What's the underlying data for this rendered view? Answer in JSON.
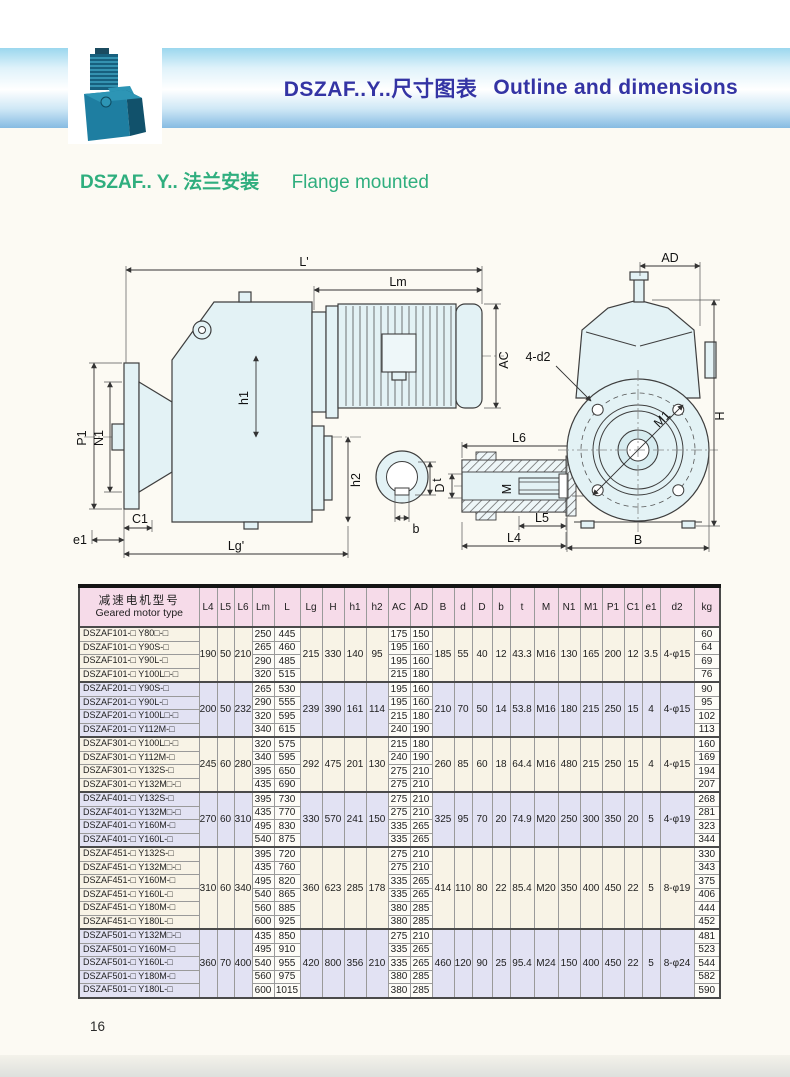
{
  "page": {
    "band_title_zh": "DSZAF..Y..尺寸图表",
    "band_title_en": "Outline and dimensions",
    "subtitle_zh": "DSZAF.. Y.. 法兰安装",
    "subtitle_en": "Flange mounted",
    "page_number": "16"
  },
  "colors": {
    "band_top": "#9bd7ee",
    "band_bottom": "#86bbe2",
    "title_text": "#3434a4",
    "subtitle_text": "#2fae7e",
    "table_header_bg": "#f6dbe9",
    "group_cream_bg": "#f8f3e6",
    "group_lavender_bg": "#e2e2f3"
  },
  "diagram": {
    "labels": {
      "l_total": "L'",
      "lm": "Lm",
      "ac": "AC",
      "h1": "h1",
      "h2": "h2",
      "p1": "P1",
      "n1": "N1",
      "e1": "e1",
      "c1": "C1",
      "lg": "Lg'",
      "b": "b",
      "t": "t",
      "l6": "L6",
      "D": "D",
      "M": "M",
      "d": "d",
      "l5": "L5",
      "l4": "L4",
      "ad": "AD",
      "d2": "4-d2",
      "H": "H",
      "m1": "M1",
      "B": "B"
    }
  },
  "table": {
    "title_cn": "减速电机型号",
    "title_en": "Geared motor type",
    "columns": [
      "L4",
      "L5",
      "L6",
      "Lm",
      "L",
      "Lg",
      "H",
      "h1",
      "h2",
      "AC",
      "AD",
      "B",
      "d",
      "D",
      "b",
      "t",
      "M",
      "N1",
      "M1",
      "P1",
      "C1",
      "e1",
      "d2",
      "kg"
    ],
    "groups": [
      {
        "shared": {
          "L4": "190",
          "L5": "50",
          "L6": "210",
          "Lg": "215",
          "H": "330",
          "h1": "140",
          "h2": "95",
          "B": "185",
          "d": "55",
          "D": "40",
          "b": "12",
          "t": "43.3",
          "M": "M16",
          "N1": "130",
          "M1": "165",
          "P1": "200",
          "C1": "12",
          "e1": "3.5",
          "d2": "4-φ15"
        },
        "rows": [
          {
            "type": "DSZAF101-□ Y80□-□",
            "Lm": "250",
            "L": "445",
            "AC": "175",
            "AD": "150",
            "kg": "60"
          },
          {
            "type": "DSZAF101-□ Y90S-□",
            "Lm": "265",
            "L": "460",
            "AC": "195",
            "AD": "160",
            "kg": "64"
          },
          {
            "type": "DSZAF101-□ Y90L-□",
            "Lm": "290",
            "L": "485",
            "AC": "195",
            "AD": "160",
            "kg": "69"
          },
          {
            "type": "DSZAF101-□ Y100L□-□",
            "Lm": "320",
            "L": "515",
            "AC": "215",
            "AD": "180",
            "kg": "76"
          }
        ]
      },
      {
        "shared": {
          "L4": "200",
          "L5": "50",
          "L6": "232",
          "Lg": "239",
          "H": "390",
          "h1": "161",
          "h2": "114",
          "B": "210",
          "d": "70",
          "D": "50",
          "b": "14",
          "t": "53.8",
          "M": "M16",
          "N1": "180",
          "M1": "215",
          "P1": "250",
          "C1": "15",
          "e1": "4",
          "d2": "4-φ15"
        },
        "rows": [
          {
            "type": "DSZAF201-□ Y90S-□",
            "Lm": "265",
            "L": "530",
            "AC": "195",
            "AD": "160",
            "kg": "90"
          },
          {
            "type": "DSZAF201-□ Y90L-□",
            "Lm": "290",
            "L": "555",
            "AC": "195",
            "AD": "160",
            "kg": "95"
          },
          {
            "type": "DSZAF201-□ Y100L□-□",
            "Lm": "320",
            "L": "595",
            "AC": "215",
            "AD": "180",
            "kg": "102"
          },
          {
            "type": "DSZAF201-□ Y112M-□",
            "Lm": "340",
            "L": "615",
            "AC": "240",
            "AD": "190",
            "kg": "113"
          }
        ]
      },
      {
        "shared": {
          "L4": "245",
          "L5": "60",
          "L6": "280",
          "Lg": "292",
          "H": "475",
          "h1": "201",
          "h2": "130",
          "B": "260",
          "d": "85",
          "D": "60",
          "b": "18",
          "t": "64.4",
          "M": "M16",
          "N1": "480",
          "M1": "215",
          "P1": "250",
          "C1": "15",
          "e1": "4",
          "d2": "4-φ15"
        },
        "rows": [
          {
            "type": "DSZAF301-□ Y100L□-□",
            "Lm": "320",
            "L": "575",
            "AC": "215",
            "AD": "180",
            "kg": "160"
          },
          {
            "type": "DSZAF301-□ Y112M-□",
            "Lm": "340",
            "L": "595",
            "AC": "240",
            "AD": "190",
            "kg": "169"
          },
          {
            "type": "DSZAF301-□ Y132S-□",
            "Lm": "395",
            "L": "650",
            "AC": "275",
            "AD": "210",
            "kg": "194"
          },
          {
            "type": "DSZAF301-□ Y132M□-□",
            "Lm": "435",
            "L": "690",
            "AC": "275",
            "AD": "210",
            "kg": "207"
          }
        ]
      },
      {
        "shared": {
          "L4": "270",
          "L5": "60",
          "L6": "310",
          "Lg": "330",
          "H": "570",
          "h1": "241",
          "h2": "150",
          "B": "325",
          "d": "95",
          "D": "70",
          "b": "20",
          "t": "74.9",
          "M": "M20",
          "N1": "250",
          "M1": "300",
          "P1": "350",
          "C1": "20",
          "e1": "5",
          "d2": "4-φ19"
        },
        "rows": [
          {
            "type": "DSZAF401-□ Y132S-□",
            "Lm": "395",
            "L": "730",
            "AC": "275",
            "AD": "210",
            "kg": "268"
          },
          {
            "type": "DSZAF401-□ Y132M□-□",
            "Lm": "435",
            "L": "770",
            "AC": "275",
            "AD": "210",
            "kg": "281"
          },
          {
            "type": "DSZAF401-□ Y160M-□",
            "Lm": "495",
            "L": "830",
            "AC": "335",
            "AD": "265",
            "kg": "323"
          },
          {
            "type": "DSZAF401-□ Y160L-□",
            "Lm": "540",
            "L": "875",
            "AC": "335",
            "AD": "265",
            "kg": "344"
          }
        ]
      },
      {
        "shared": {
          "L4": "310",
          "L5": "60",
          "L6": "340",
          "Lg": "360",
          "H": "623",
          "h1": "285",
          "h2": "178",
          "B": "414",
          "d": "110",
          "D": "80",
          "b": "22",
          "t": "85.4",
          "M": "M20",
          "N1": "350",
          "M1": "400",
          "P1": "450",
          "C1": "22",
          "e1": "5",
          "d2": "8-φ19"
        },
        "rows": [
          {
            "type": "DSZAF451-□ Y132S-□",
            "Lm": "395",
            "L": "720",
            "AC": "275",
            "AD": "210",
            "kg": "330"
          },
          {
            "type": "DSZAF451-□ Y132M□-□",
            "Lm": "435",
            "L": "760",
            "AC": "275",
            "AD": "210",
            "kg": "343"
          },
          {
            "type": "DSZAF451-□ Y160M-□",
            "Lm": "495",
            "L": "820",
            "AC": "335",
            "AD": "265",
            "kg": "375"
          },
          {
            "type": "DSZAF451-□ Y160L-□",
            "Lm": "540",
            "L": "865",
            "AC": "335",
            "AD": "265",
            "kg": "406"
          },
          {
            "type": "DSZAF451-□ Y180M-□",
            "Lm": "560",
            "L": "885",
            "AC": "380",
            "AD": "285",
            "kg": "444"
          },
          {
            "type": "DSZAF451-□ Y180L-□",
            "Lm": "600",
            "L": "925",
            "AC": "380",
            "AD": "285",
            "kg": "452"
          }
        ]
      },
      {
        "shared": {
          "L4": "360",
          "L5": "70",
          "L6": "400",
          "Lg": "420",
          "H": "800",
          "h1": "356",
          "h2": "210",
          "B": "460",
          "d": "120",
          "D": "90",
          "b": "25",
          "t": "95.4",
          "M": "M24",
          "N1": "150",
          "M1": "400",
          "P1": "450",
          "C1": "22",
          "e1": "5",
          "d2": "8-φ24"
        },
        "rows": [
          {
            "type": "DSZAF501-□ Y132M□-□",
            "Lm": "435",
            "L": "850",
            "AC": "275",
            "AD": "210",
            "kg": "481"
          },
          {
            "type": "DSZAF501-□ Y160M-□",
            "Lm": "495",
            "L": "910",
            "AC": "335",
            "AD": "265",
            "kg": "523"
          },
          {
            "type": "DSZAF501-□ Y160L-□",
            "Lm": "540",
            "L": "955",
            "AC": "335",
            "AD": "265",
            "kg": "544"
          },
          {
            "type": "DSZAF501-□ Y180M-□",
            "Lm": "560",
            "L": "975",
            "AC": "380",
            "AD": "285",
            "kg": "582"
          },
          {
            "type": "DSZAF501-□ Y180L-□",
            "Lm": "600",
            "L": "1015",
            "AC": "380",
            "AD": "285",
            "kg": "590"
          }
        ]
      }
    ]
  }
}
